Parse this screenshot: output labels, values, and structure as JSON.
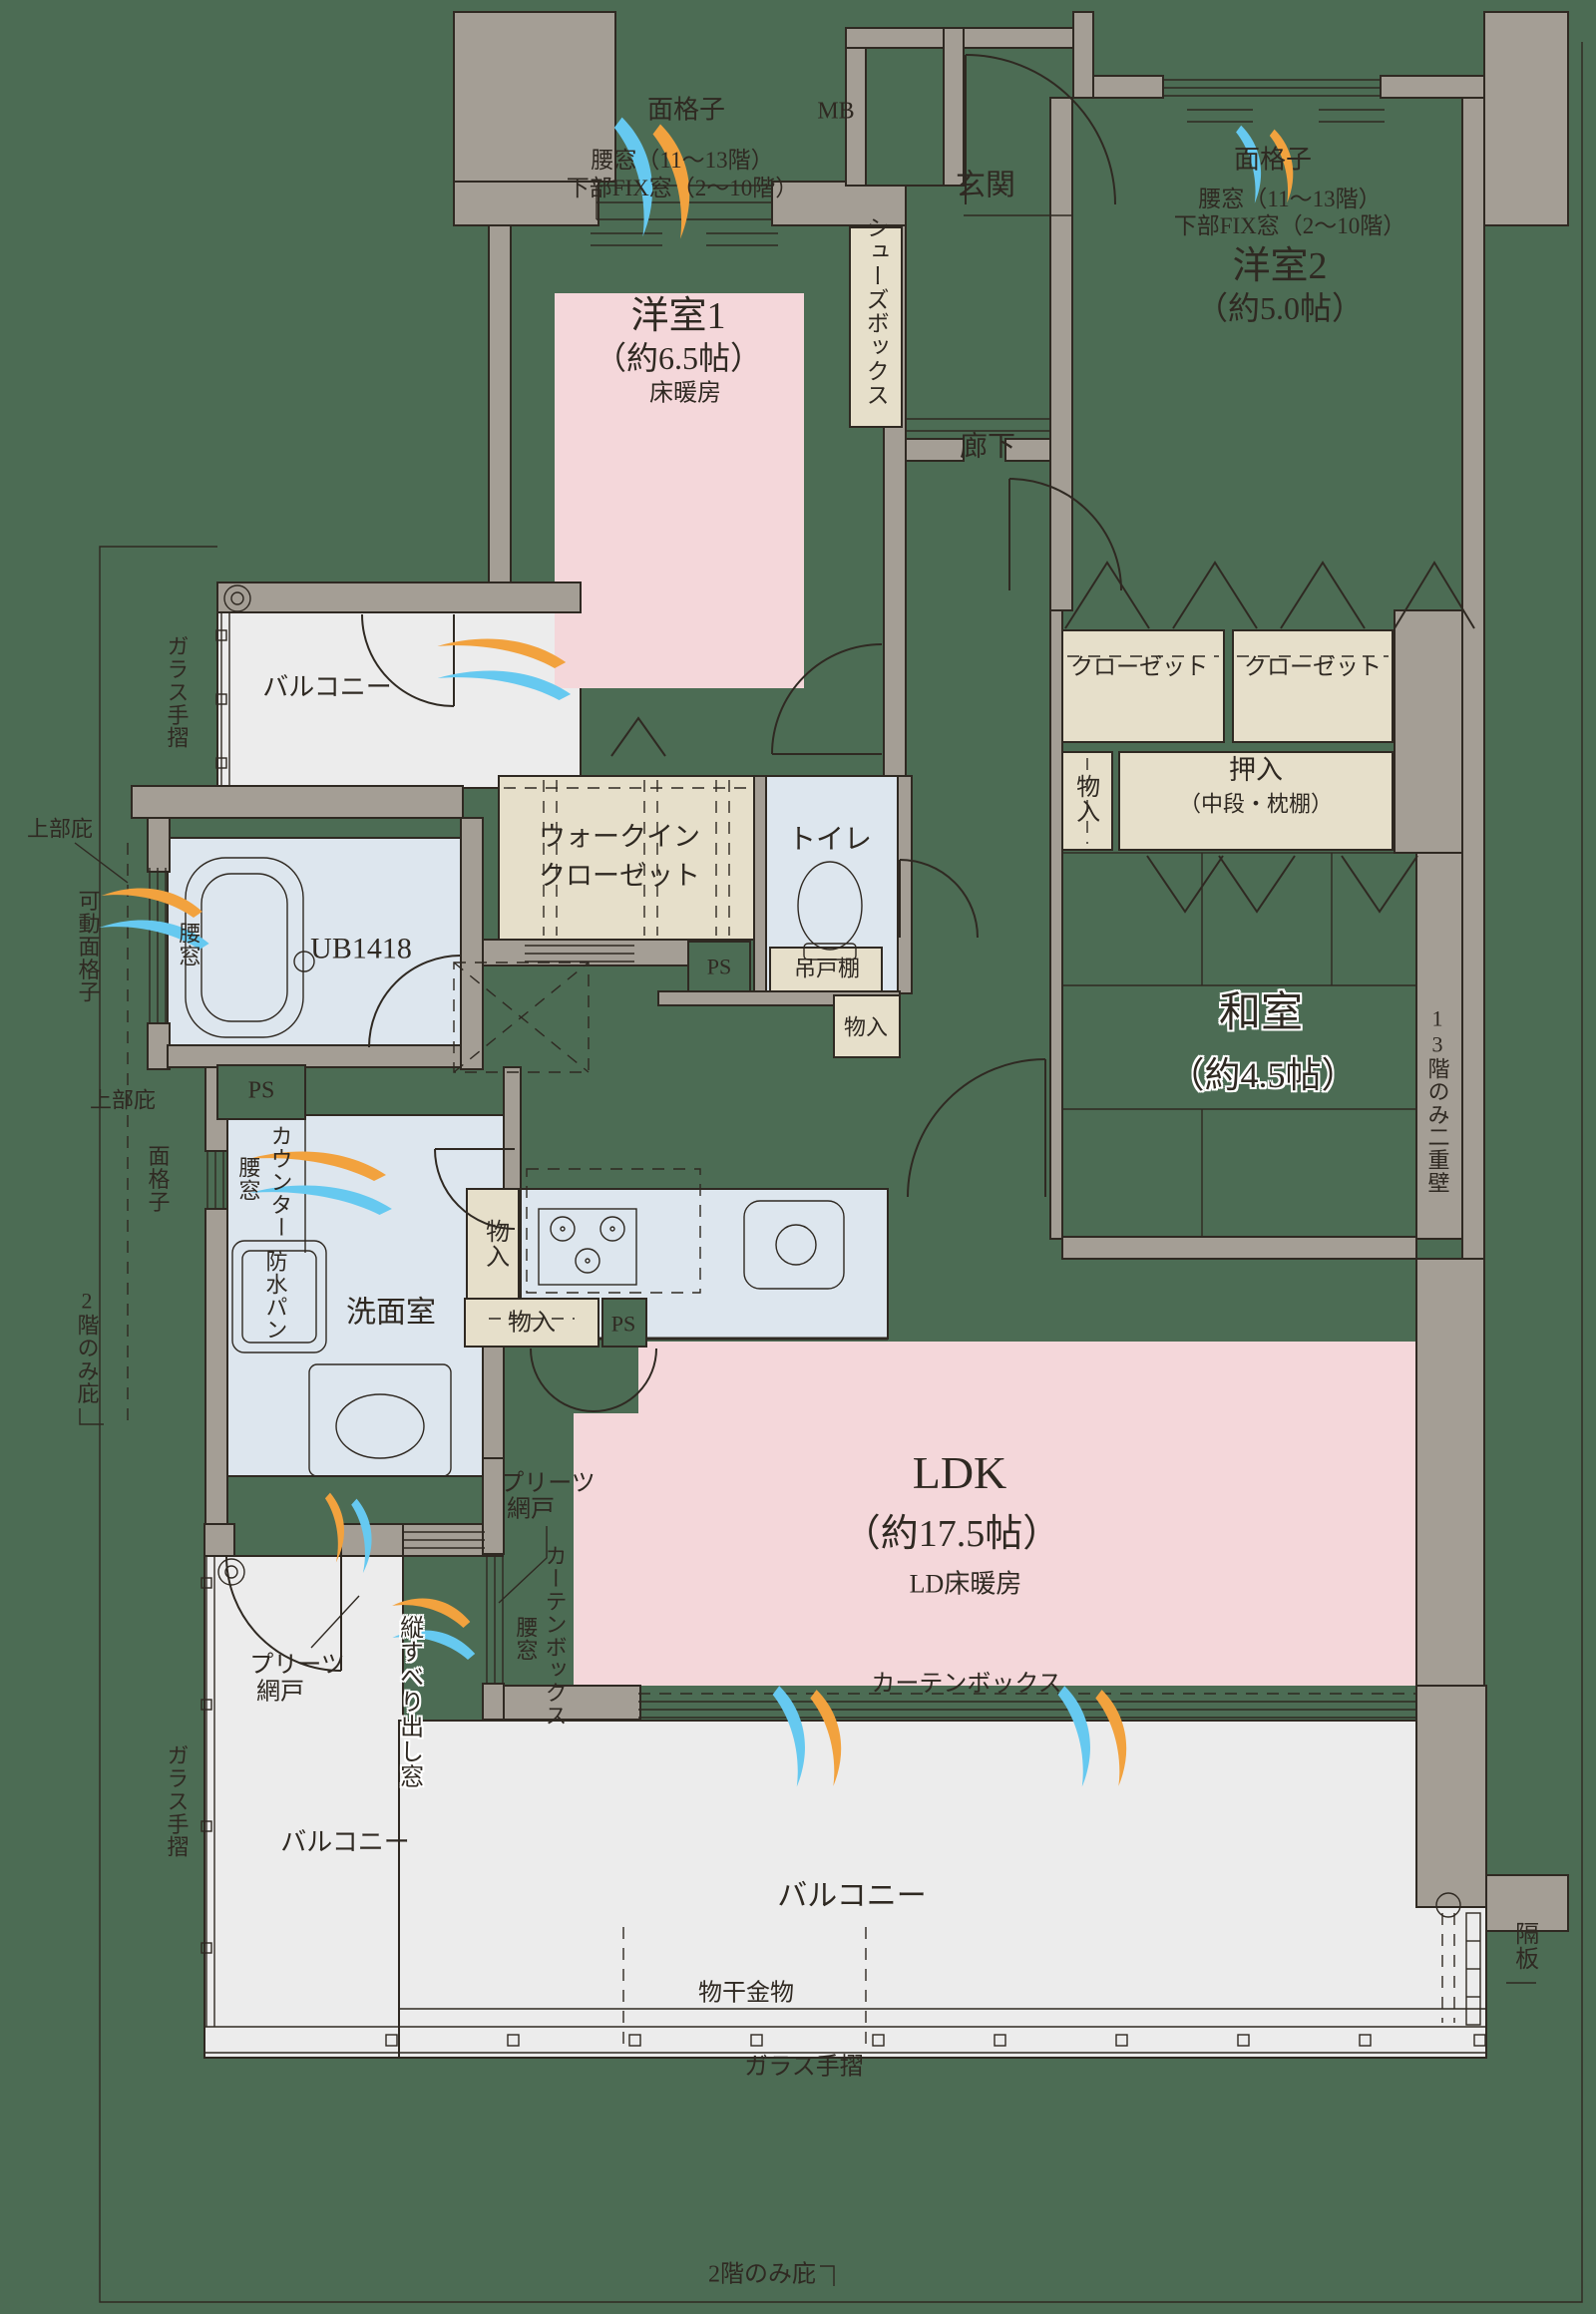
{
  "colors": {
    "bg": "#4c6c54",
    "wall": "#a49e95",
    "ink": "#2f2922",
    "pink": "#f4d7da",
    "beige": "#e6dfca",
    "wet": "#dde6ee",
    "balcony": "#ececec",
    "arrow_orange": "#f2a23e",
    "arrow_blue": "#66c9f0"
  },
  "labels": {
    "mengoshi": "面格子",
    "koshimado_note1": "腰窓（11～13階）",
    "koshimado_note2": "下部FIX窓（2～10階）",
    "mb": "MB",
    "genkan": "玄関",
    "shoes_box": "シューズボックス",
    "room1_name": "洋室1",
    "room1_size": "（約6.5帖）",
    "room1_note": "床暖房",
    "room2_name": "洋室2",
    "room2_size": "（約5.0帖）",
    "rouka": "廊下",
    "closet": "クローゼット",
    "monoire": "物入",
    "oshiire": "押入",
    "oshiire_note": "（中段・枕棚）",
    "washitsu_name": "和室",
    "washitsu_size": "（約4.5帖）",
    "double_wall_note": "13階のみ二重壁",
    "balcony": "バルコニー",
    "glass_rail": "ガラス手摺",
    "joubu_hisashi": "上部庇",
    "kadou_mengoshi": "可動面格子",
    "koshimado": "腰窓",
    "ub": "UB1418",
    "wic_line1": "ウォークイン",
    "wic_line2": "クローゼット",
    "toilet": "トイレ",
    "ps": "PS",
    "tsuridana": "吊戸棚",
    "counter": "カウンター",
    "bousui_pan": "防水パン",
    "senmenshitsu": "洗面室",
    "ldk_name": "LDK",
    "ldk_size": "（約17.5帖）",
    "ldk_note": "LD床暖房",
    "curtain_box": "カーテンボックス",
    "pleats_line1": "プリーツ",
    "pleats_line2": "網戸",
    "tatesuberi": "縦すべり出し窓",
    "monohoshi": "物干金物",
    "kakuita": "隔板",
    "nikai_hisashi": "2階のみ庇"
  }
}
